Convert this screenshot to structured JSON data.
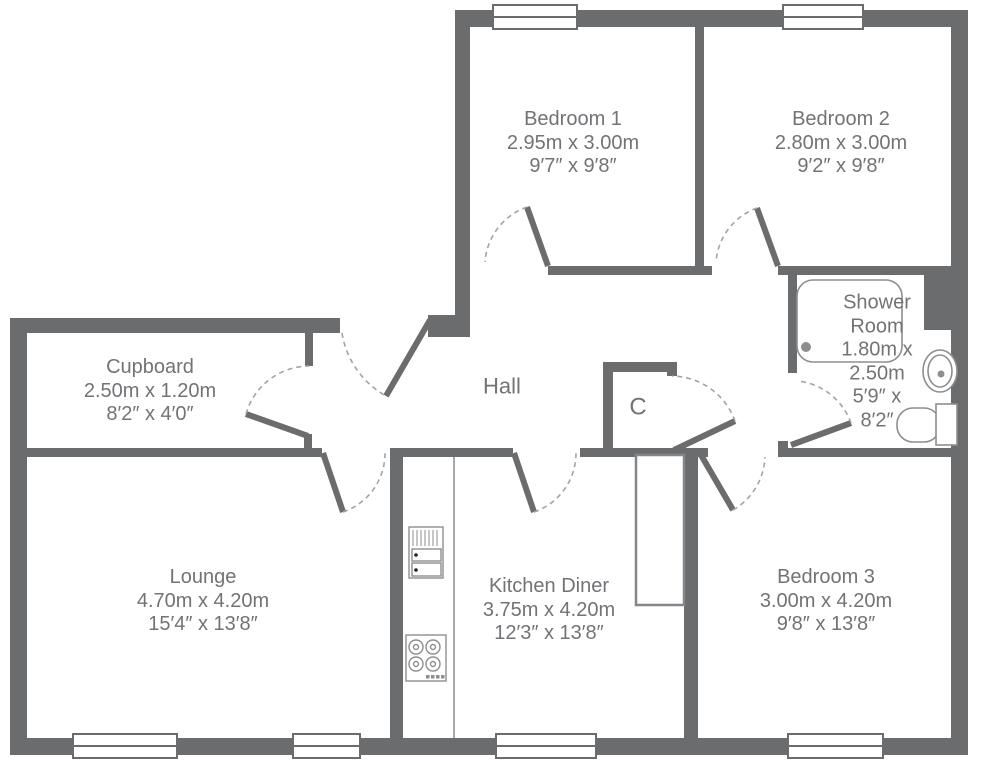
{
  "page": {
    "background": "#ffffff"
  },
  "plan": {
    "wall_color": "#6b6c6e",
    "label_color": "#727376",
    "rooms": {
      "bedroom1": {
        "lines": [
          "Bedroom 1",
          "2.95m x 3.00m",
          "9′7″ x 9′8″"
        ]
      },
      "bedroom2": {
        "lines": [
          "Bedroom 2",
          "2.80m x 3.00m",
          "9′2″ x 9′8″"
        ]
      },
      "shower_room": {
        "lines": [
          "Shower",
          "Room",
          "1.80m x",
          "2.50m",
          "5′9″ x",
          "8′2″"
        ]
      },
      "cupboard": {
        "lines": [
          "Cupboard",
          "2.50m x 1.20m",
          "8′2″ x 4′0″"
        ]
      },
      "hall": {
        "lines": [
          "Hall"
        ]
      },
      "closet": {
        "lines": [
          "C"
        ]
      },
      "lounge": {
        "lines": [
          "Lounge",
          "4.70m x 4.20m",
          "15′4″ x 13′8″"
        ]
      },
      "kitchen_diner": {
        "lines": [
          "Kitchen Diner",
          "3.75m x 4.20m",
          "12′3″ x 13′8″"
        ]
      },
      "bedroom3": {
        "lines": [
          "Bedroom 3",
          "3.00m x 4.20m",
          "9′8″ x 13′8″"
        ]
      }
    },
    "fixtures": [
      "shower-tray",
      "wash-basin",
      "toilet",
      "oven",
      "hob",
      "kitchen-counter",
      "boiler-cupboard"
    ],
    "doors": [
      "entrance",
      "bedroom-1",
      "bedroom-2",
      "bedroom-3",
      "shower-room",
      "cupboard",
      "lounge",
      "kitchen",
      "hall-closet"
    ],
    "window_count": 6
  }
}
